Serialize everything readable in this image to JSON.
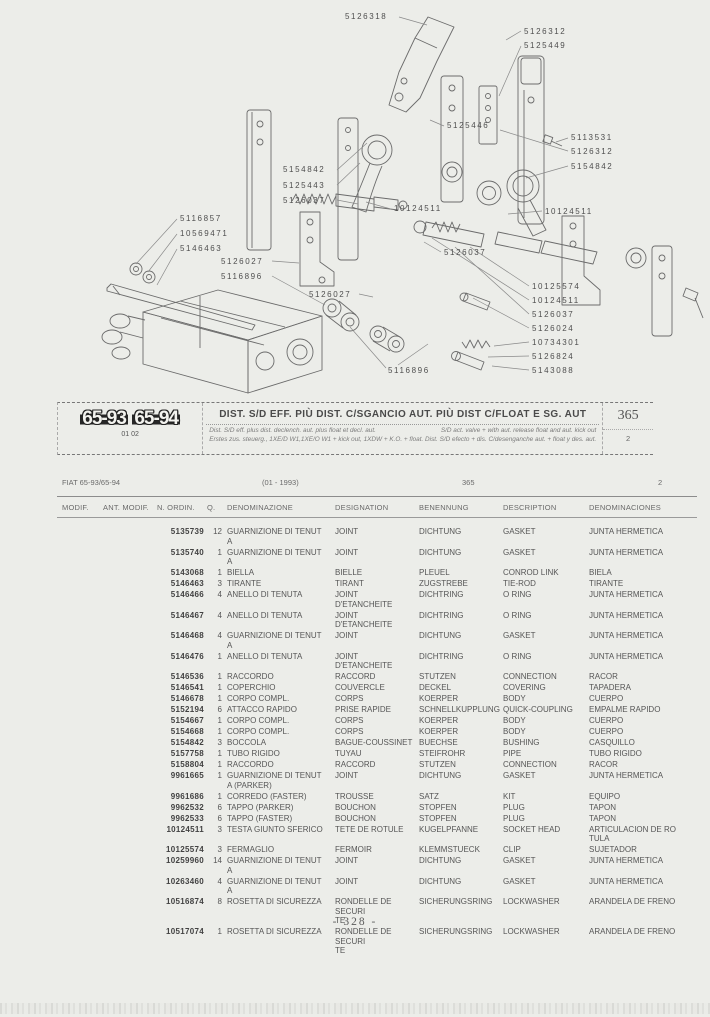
{
  "page": {
    "footer": "- 328 -"
  },
  "diagram": {
    "labels": [
      {
        "text": "5126318",
        "x": 345,
        "y": 12
      },
      {
        "text": "5126312",
        "x": 524,
        "y": 27
      },
      {
        "text": "5125449",
        "x": 524,
        "y": 41
      },
      {
        "text": "5125446",
        "x": 447,
        "y": 121
      },
      {
        "text": "5113531",
        "x": 571,
        "y": 133
      },
      {
        "text": "5126312",
        "x": 571,
        "y": 147
      },
      {
        "text": "5154842",
        "x": 571,
        "y": 162
      },
      {
        "text": "5154842",
        "x": 283,
        "y": 165
      },
      {
        "text": "5125443",
        "x": 283,
        "y": 181
      },
      {
        "text": "5126037",
        "x": 283,
        "y": 196
      },
      {
        "text": "10124511",
        "x": 394,
        "y": 204
      },
      {
        "text": "10124511",
        "x": 545,
        "y": 207
      },
      {
        "text": "5116857",
        "x": 180,
        "y": 214
      },
      {
        "text": "10569471",
        "x": 180,
        "y": 229
      },
      {
        "text": "5146463",
        "x": 180,
        "y": 244
      },
      {
        "text": "5126027",
        "x": 221,
        "y": 257
      },
      {
        "text": "5116896",
        "x": 221,
        "y": 272
      },
      {
        "text": "5126037",
        "x": 444,
        "y": 248
      },
      {
        "text": "5126027",
        "x": 309,
        "y": 290
      },
      {
        "text": "10125574",
        "x": 532,
        "y": 282
      },
      {
        "text": "10124511",
        "x": 532,
        "y": 296
      },
      {
        "text": "5126037",
        "x": 532,
        "y": 310
      },
      {
        "text": "5126024",
        "x": 532,
        "y": 324
      },
      {
        "text": "10734301",
        "x": 532,
        "y": 338
      },
      {
        "text": "5126824",
        "x": 532,
        "y": 352
      },
      {
        "text": "5143088",
        "x": 532,
        "y": 366
      },
      {
        "text": "5116896",
        "x": 388,
        "y": 366
      }
    ]
  },
  "header_band": {
    "badge1": "65-93",
    "badge2": "65-94",
    "badge_sub": "01 02",
    "title": "DIST. S/D EFF. PIÙ DIST. C/SGANCIO AUT. PIÙ DIST C/FLOAT E SG. AUT",
    "sub_left1": "Dist. S/D eff. plus dist. declench. aut. plus float et decl. aut.",
    "sub_right1": "S/D act. valve + with aut. release float and aut. kick out",
    "sub_line2": "Erstes zus. steuerg., 1XE/D W1,1XE/O W1 + kick out, 1XDW + K.O. + float.  Dist. S/D efecto + dis. C/desenganche aut. + float y des. aut.",
    "page_ref": "365",
    "sheet": "2"
  },
  "table": {
    "meta": {
      "model": "FIAT 65-93/65-94",
      "date": "(01 - 1993)",
      "page_ref": "365",
      "sheet": "2"
    },
    "columns": [
      "MODIF.",
      "ANT. MODIF.",
      "N. ORDIN.",
      "Q.",
      "DENOMINAZIONE",
      "DESIGNATION",
      "BENENNUNG",
      "DESCRIPTION",
      "DENOMINACIONES"
    ],
    "rows": [
      {
        "n": "5135739",
        "q": "12",
        "it": "GUARNIZIONE DI TENUT\nA",
        "fr": "JOINT",
        "de": "DICHTUNG",
        "en": "GASKET",
        "es": "JUNTA HERMETICA"
      },
      {
        "n": "5135740",
        "q": "1",
        "it": "GUARNIZIONE DI TENUT\nA",
        "fr": "JOINT",
        "de": "DICHTUNG",
        "en": "GASKET",
        "es": "JUNTA HERMETICA"
      },
      {
        "n": "5143068",
        "q": "1",
        "it": "BIELLA",
        "fr": "BIELLE",
        "de": "PLEUEL",
        "en": "CONROD LINK",
        "es": "BIELA"
      },
      {
        "n": "5146463",
        "q": "3",
        "it": "TIRANTE",
        "fr": "TIRANT",
        "de": "ZUGSTREBE",
        "en": "TIE-ROD",
        "es": "TIRANTE"
      },
      {
        "n": "5146466",
        "q": "4",
        "it": "ANELLO DI TENUTA",
        "fr": "JOINT D'ETANCHEITE",
        "de": "DICHTRING",
        "en": "O RING",
        "es": "JUNTA HERMETICA"
      },
      {
        "n": "5146467",
        "q": "4",
        "it": "ANELLO DI TENUTA",
        "fr": "JOINT D'ETANCHEITE",
        "de": "DICHTRING",
        "en": "O RING",
        "es": "JUNTA HERMETICA"
      },
      {
        "n": "5146468",
        "q": "4",
        "it": "GUARNIZIONE DI TENUT\nA",
        "fr": "JOINT",
        "de": "DICHTUNG",
        "en": "GASKET",
        "es": "JUNTA HERMETICA"
      },
      {
        "n": "5146476",
        "q": "1",
        "it": "ANELLO DI TENUTA",
        "fr": "JOINT D'ETANCHEITE",
        "de": "DICHTRING",
        "en": "O RING",
        "es": "JUNTA HERMETICA"
      },
      {
        "n": "5146536",
        "q": "1",
        "it": "RACCORDO",
        "fr": "RACCORD",
        "de": "STUTZEN",
        "en": "CONNECTION",
        "es": "RACOR"
      },
      {
        "n": "5146541",
        "q": "1",
        "it": "COPERCHIO",
        "fr": "COUVERCLE",
        "de": "DECKEL",
        "en": "COVERING",
        "es": "TAPADERA"
      },
      {
        "n": "5146678",
        "q": "1",
        "it": "CORPO COMPL.",
        "fr": "CORPS",
        "de": "KOERPER",
        "en": "BODY",
        "es": "CUERPO"
      },
      {
        "n": "5152194",
        "q": "6",
        "it": "ATTACCO RAPIDO",
        "fr": "PRISE RAPIDE",
        "de": "SCHNELLKUPPLUNG",
        "en": "QUICK-COUPLING",
        "es": "EMPALME RAPIDO"
      },
      {
        "n": "5154667",
        "q": "1",
        "it": "CORPO COMPL.",
        "fr": "CORPS",
        "de": "KOERPER",
        "en": "BODY",
        "es": "CUERPO"
      },
      {
        "n": "5154668",
        "q": "1",
        "it": "CORPO COMPL.",
        "fr": "CORPS",
        "de": "KOERPER",
        "en": "BODY",
        "es": "CUERPO"
      },
      {
        "n": "5154842",
        "q": "3",
        "it": "BOCCOLA",
        "fr": "BAGUE-COUSSINET",
        "de": "BUECHSE",
        "en": "BUSHING",
        "es": "CASQUILLO"
      },
      {
        "n": "5157758",
        "q": "1",
        "it": "TUBO RIGIDO",
        "fr": "TUYAU",
        "de": "STEIFROHR",
        "en": "PIPE",
        "es": "TUBO RIGIDO"
      },
      {
        "n": "5158804",
        "q": "1",
        "it": "RACCORDO",
        "fr": "RACCORD",
        "de": "STUTZEN",
        "en": "CONNECTION",
        "es": "RACOR"
      },
      {
        "n": "9961665",
        "q": "1",
        "it": "GUARNIZIONE DI TENUT\nA (PARKER)",
        "fr": "JOINT",
        "de": "DICHTUNG",
        "en": "GASKET",
        "es": "JUNTA HERMETICA"
      },
      {
        "n": "9961686",
        "q": "1",
        "it": "CORREDO (FASTER)",
        "fr": "TROUSSE",
        "de": "SATZ",
        "en": "KIT",
        "es": "EQUIPO"
      },
      {
        "n": "9962532",
        "q": "6",
        "it": "TAPPO (PARKER)",
        "fr": "BOUCHON",
        "de": "STOPFEN",
        "en": "PLUG",
        "es": "TAPON"
      },
      {
        "n": "9962533",
        "q": "6",
        "it": "TAPPO (FASTER)",
        "fr": "BOUCHON",
        "de": "STOPFEN",
        "en": "PLUG",
        "es": "TAPON"
      },
      {
        "n": "10124511",
        "q": "3",
        "it": "TESTA GIUNTO SFERICO",
        "fr": "TETE DE ROTULE",
        "de": "KUGELPFANNE",
        "en": "SOCKET HEAD",
        "es": "ARTICULACION DE RO\nTULA"
      },
      {
        "n": "10125574",
        "q": "3",
        "it": "FERMAGLIO",
        "fr": "FERMOIR",
        "de": "KLEMMSTUECK",
        "en": "CLIP",
        "es": "SUJETADOR"
      },
      {
        "n": "10259960",
        "q": "14",
        "it": "GUARNIZIONE DI TENUT\nA",
        "fr": "JOINT",
        "de": "DICHTUNG",
        "en": "GASKET",
        "es": "JUNTA HERMETICA"
      },
      {
        "n": "10263460",
        "q": "4",
        "it": "GUARNIZIONE DI TENUT\nA",
        "fr": "JOINT",
        "de": "DICHTUNG",
        "en": "GASKET",
        "es": "JUNTA HERMETICA"
      },
      {
        "n": "10516874",
        "q": "8",
        "it": "ROSETTA DI SICUREZZA",
        "fr": "RONDELLE DE SECURI\nTE",
        "de": "SICHERUNGSRING",
        "en": "LOCKWASHER",
        "es": "ARANDELA DE FRENO"
      },
      {
        "n": "10517074",
        "q": "1",
        "it": "ROSETTA DI SICUREZZA",
        "fr": "RONDELLE DE SECURI\nTE",
        "de": "SICHERUNGSRING",
        "en": "LOCKWASHER",
        "es": "ARANDELA DE FRENO"
      }
    ]
  }
}
